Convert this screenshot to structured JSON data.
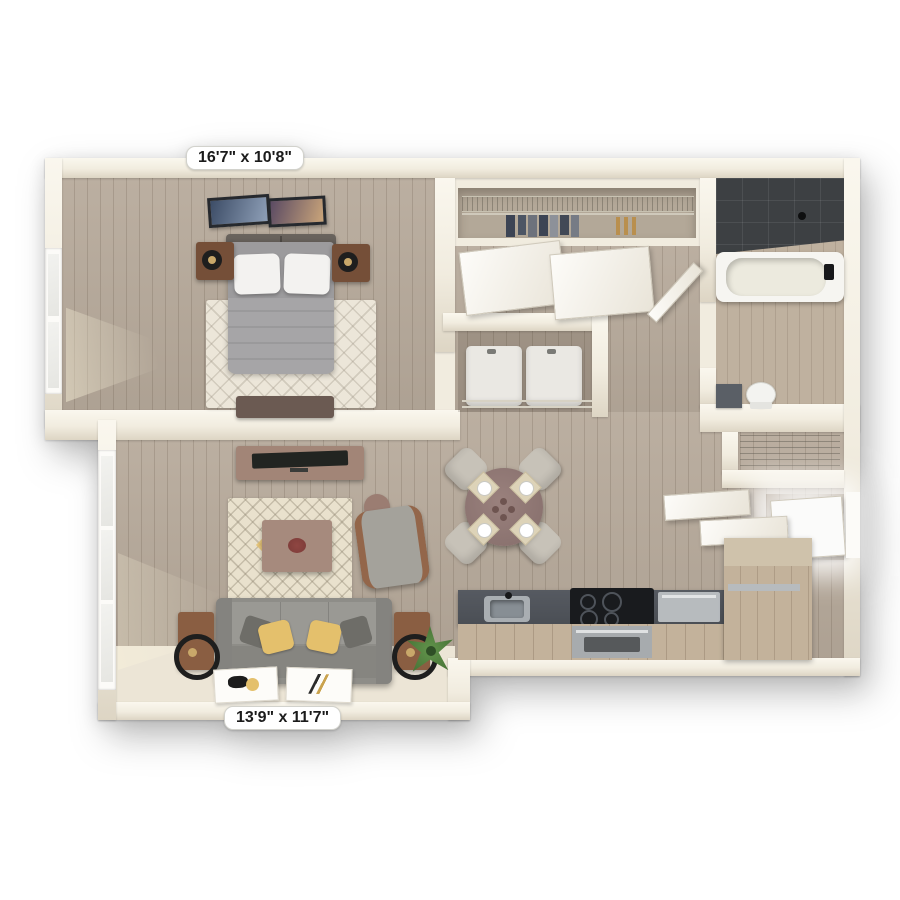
{
  "labels": {
    "bedroom_dimensions": "16'7\" x 10'8\"",
    "living_room_dimensions": "13'9\" x 11'7\""
  },
  "plan": {
    "view": "3d-top-down-floor-plan",
    "rooms": [
      {
        "key": "bedroom",
        "furniture": [
          "bed",
          "white-pillows",
          "gray-duvet",
          "headboard",
          "nightstand-left",
          "nightstand-right",
          "reading-lamp-left",
          "reading-lamp-right",
          "area-rug",
          "foot-bench",
          "framed-art",
          "window"
        ]
      },
      {
        "key": "closet",
        "furniture": [
          "wire-shelf",
          "clothes-rod",
          "hanging-clothes",
          "sliding-doors"
        ]
      },
      {
        "key": "laundry-closet",
        "furniture": [
          "washer",
          "dryer",
          "wire-rail"
        ]
      },
      {
        "key": "bathroom",
        "furniture": [
          "walk-in-shower",
          "shower-head",
          "bathtub",
          "faucet",
          "toilet",
          "vanity",
          "door"
        ]
      },
      {
        "key": "linen-closet",
        "furniture": [
          "wire-shelves"
        ]
      },
      {
        "key": "entry",
        "furniture": [
          "entry-door",
          "upper-cabinets"
        ]
      },
      {
        "key": "kitchen",
        "furniture": [
          "countertop",
          "sink",
          "faucet",
          "cooktop",
          "oven",
          "dishwasher",
          "cabinets",
          "peninsula"
        ]
      },
      {
        "key": "dining",
        "furniture": [
          "round-table",
          "chairs",
          "place-settings"
        ]
      },
      {
        "key": "living-room",
        "furniture": [
          "sofa",
          "throw-pillows",
          "side-tables",
          "arc-lamps",
          "coffee-table",
          "centerpiece",
          "area-rug",
          "armchair",
          "accent-table",
          "tv-console",
          "tv",
          "plant",
          "art-prints",
          "french-window"
        ]
      }
    ]
  },
  "palette": {
    "background": "#ffffff",
    "wall": "#f1ecdf",
    "wallhi": "#faf7ee",
    "wallsh": "#ddd5c4",
    "wood": "#b7aa9b",
    "woodlight": "#bfb19f",
    "creamfloor": "#ece5d6",
    "closetfloor": "#b3a898",
    "shower": "#3d4043",
    "tub": "#f6f5f1",
    "appliance": "#eae8e3",
    "counter": "#4a4e54",
    "cooktop": "#191b1e",
    "stainless": "#b7bbbe",
    "cabinet": "#c3b29b",
    "sofa": "#8e8d88",
    "pillowyellow": "#e4c06c",
    "pillowdark": "#6e6d68",
    "rugliving": "#e9e1cd",
    "rugbed": "#ece6d9",
    "coffeetable": "#a68a7d",
    "tvconsole": "#a28577",
    "tv": "#222421",
    "armchair": "#a4a29b",
    "armwood": "#93664a",
    "sidetable": "#8a5e42",
    "lamp": "#1e1e1e",
    "diningtable": "#8b7370",
    "chair": "#c7c2b8",
    "bed": "#9c9b9d",
    "duvet": "#a6a5a7",
    "headboard": "#57524d",
    "pillowwhite": "#f3f2f0",
    "nightstand": "#754f38",
    "plantdark": "#3f6b31",
    "plantlight": "#62934b",
    "doorwhite": "#fcfbf8",
    "glass": "#e6e6e2",
    "labelbg": "#ffffff",
    "labeltext": "#1b1b1b",
    "toilet": "#f3f3f0",
    "vanity": "#5a5f66",
    "framedark": "#26292e",
    "gold": "#c9a86a",
    "navy": "#3c4454",
    "tan": "#b98f4e",
    "bench": "#6b5a52"
  }
}
